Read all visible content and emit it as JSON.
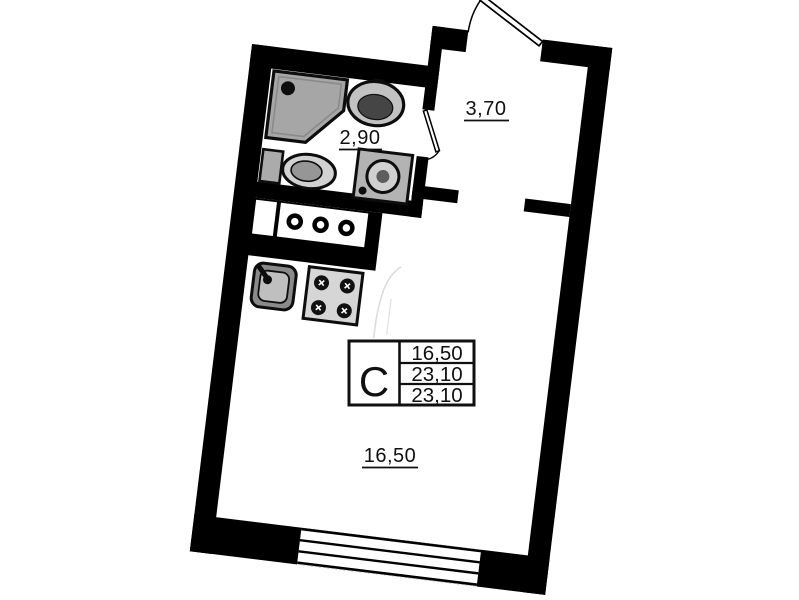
{
  "plan": {
    "rooms": [
      {
        "id": "bathroom",
        "area": "2,90"
      },
      {
        "id": "hallway",
        "area": "3,70"
      },
      {
        "id": "living-room",
        "area": "16,50"
      }
    ],
    "stamp": {
      "letter": "С",
      "rows": [
        "16,50",
        "23,10",
        "23,10"
      ]
    },
    "palette": {
      "wall": "#000000",
      "background": "#ffffff",
      "shower_fill": "#a6a6a6",
      "fixture_fill": "#b3b3b3",
      "stove_fill": "#d6d6d6"
    }
  }
}
